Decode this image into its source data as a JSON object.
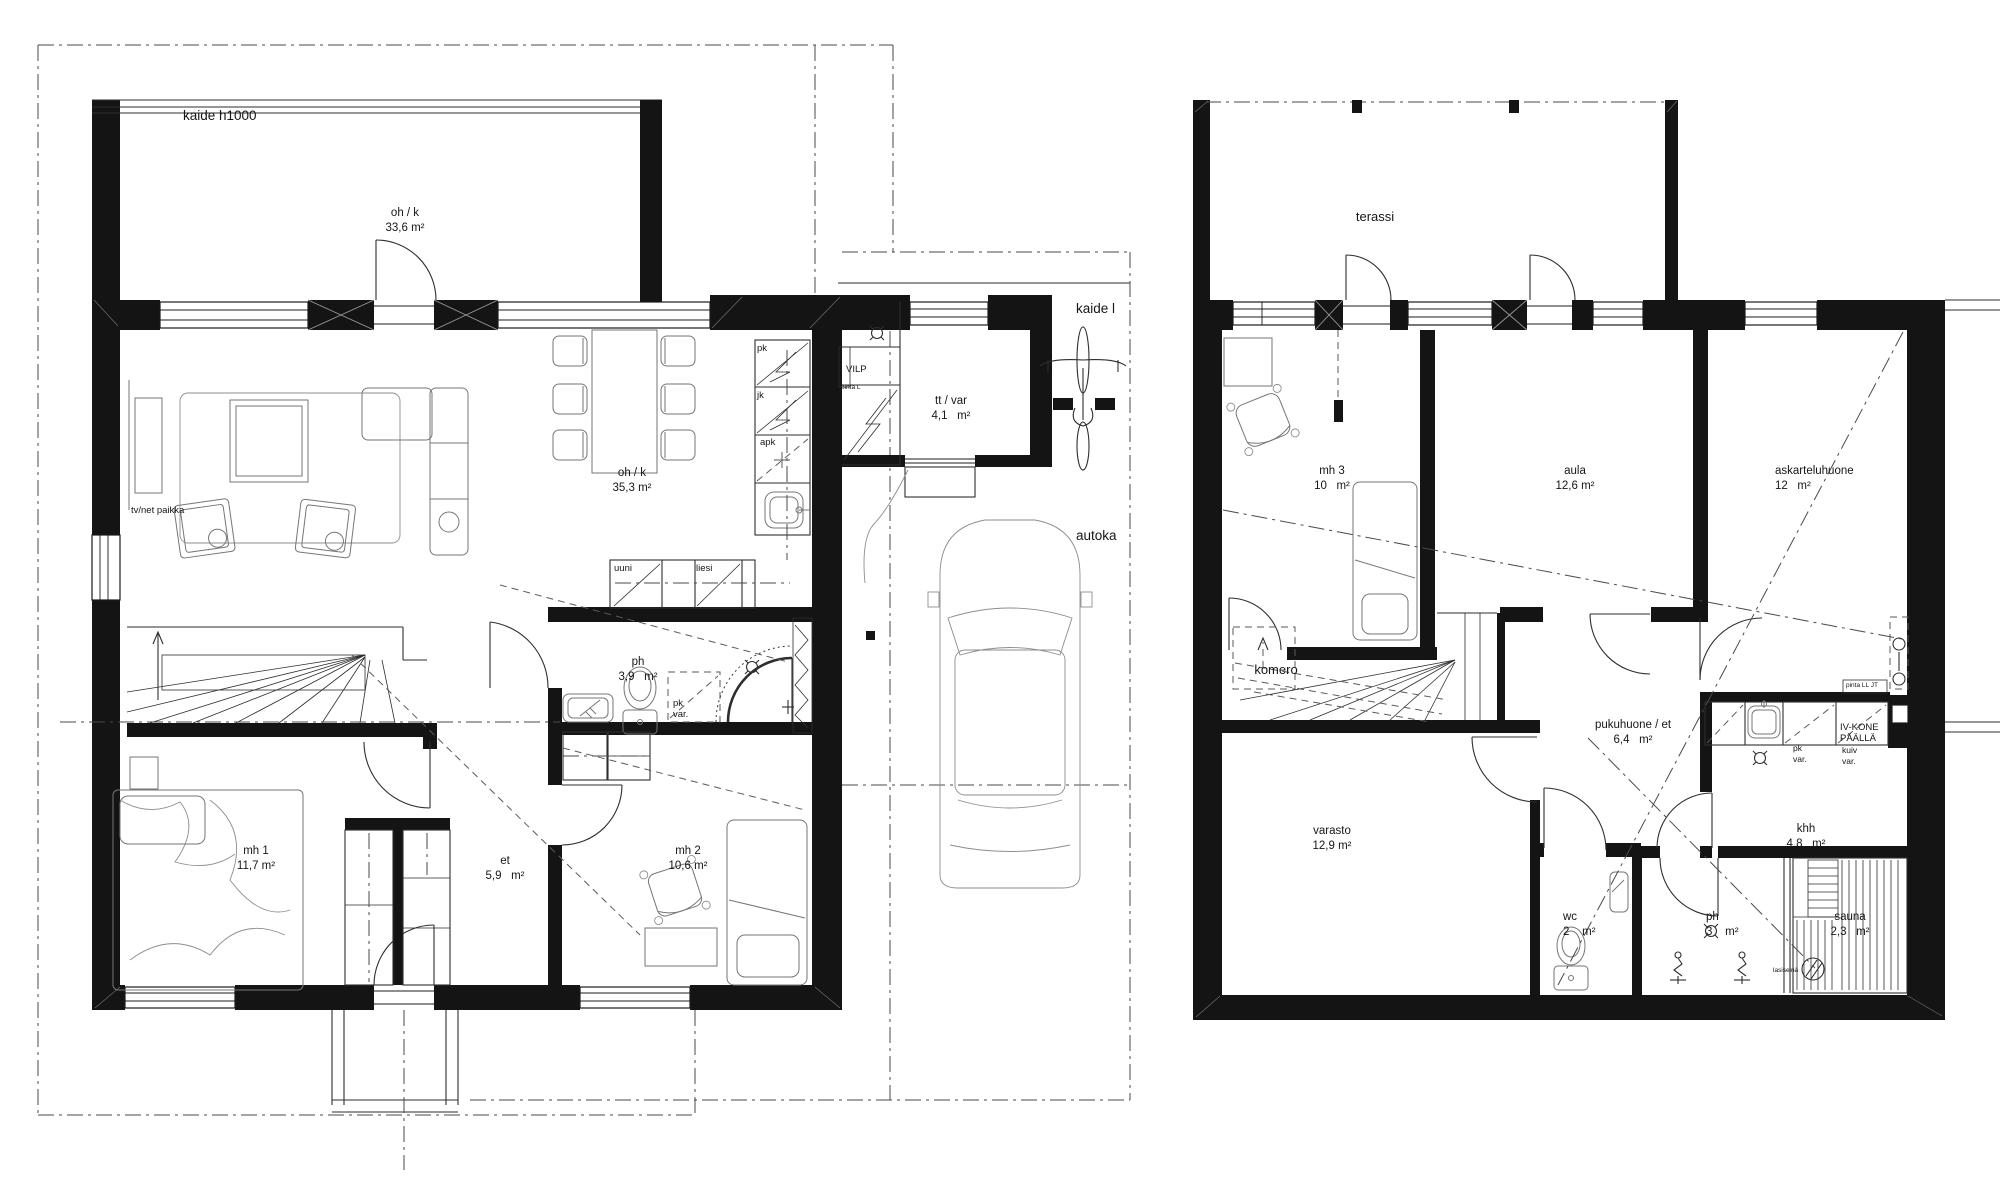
{
  "colors": {
    "ink": "#141414",
    "furniture": "#767676",
    "dashline": "#4a4a4a"
  },
  "floor1": {
    "rooms": [
      {
        "id": "balcony",
        "name": "oh / k",
        "area": "33,6 m²"
      },
      {
        "id": "living_kitchen",
        "name": "oh / k",
        "area": "35,3 m²"
      },
      {
        "id": "bathroom",
        "name": "ph",
        "area": "3,9   m²"
      },
      {
        "id": "bedroom1",
        "name": "mh 1",
        "area": "11,7 m²"
      },
      {
        "id": "hall",
        "name": "et",
        "area": "5,9   m²"
      },
      {
        "id": "bedroom2",
        "name": "mh 2",
        "area": "10,6 m²"
      },
      {
        "id": "tech_storage",
        "name": "tt / var",
        "area": "4,1   m²"
      }
    ],
    "annotations": {
      "railing": "kaide h1000",
      "tv_spot": "tv/net paikka",
      "freezer": "pk",
      "fridge": "jk",
      "dishwasher": "apk",
      "oven": "uuni",
      "stove": "liesi",
      "washer_reserve_line1": "pk",
      "washer_reserve_line2": "var.",
      "water_meter_symbol": "Ø",
      "water_meter": "VM",
      "surface_note": "pinta L",
      "heat_pump": "VILP",
      "railing_right": "kaide l",
      "carport": "autoka"
    }
  },
  "floor2": {
    "rooms": [
      {
        "id": "terrace",
        "name": "terassi",
        "area": ""
      },
      {
        "id": "bedroom3",
        "name": "mh 3",
        "area": "10   m²"
      },
      {
        "id": "hall2",
        "name": "aula",
        "area": "12,6 m²"
      },
      {
        "id": "hobby",
        "name": "askarteluhuone",
        "area": "12   m²"
      },
      {
        "id": "dressing",
        "name": "pukuhuone / et",
        "area": "6,4   m²"
      },
      {
        "id": "storage",
        "name": "varasto",
        "area": "12,9 m²"
      },
      {
        "id": "wc",
        "name": "wc",
        "area": "2    m²"
      },
      {
        "id": "shower",
        "name": "ph",
        "area": "3    m²"
      },
      {
        "id": "utility",
        "name": "khh",
        "area": "4,8   m²"
      },
      {
        "id": "sauna",
        "name": "sauna",
        "area": "2,3   m²"
      }
    ],
    "annotations": {
      "closet": "komero",
      "vent_unit_line1": "IV-KONE",
      "vent_unit_line2": "PÄÄLLÄ",
      "dryer_reserve_line1": "kuiv",
      "dryer_reserve_line2": "var.",
      "washer_reserve_line1": "pk",
      "washer_reserve_line2": "var.",
      "glass_wall": "lasiseinä",
      "surface_note": "pinta LL JT"
    }
  }
}
